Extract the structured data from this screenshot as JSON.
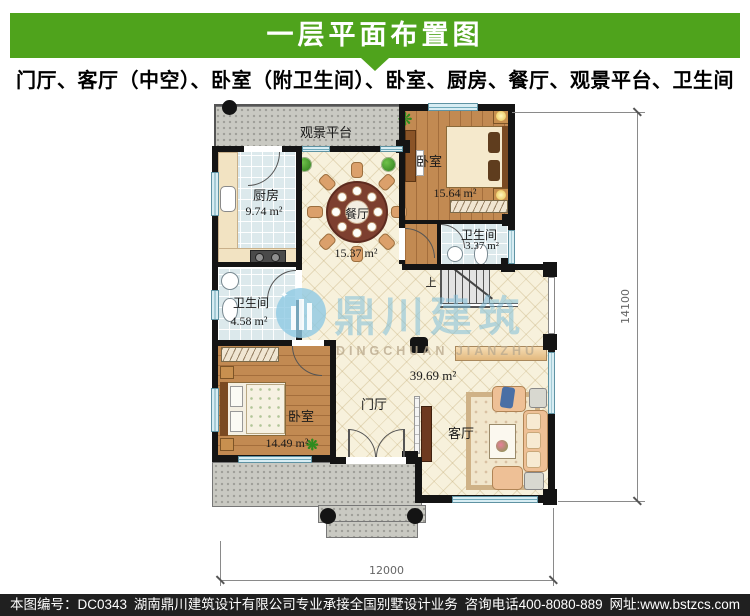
{
  "header": {
    "title": "一层平面布置图"
  },
  "subtitle": "门厅、客厅（中空）、卧室（附卫生间）、卧室、厨房、餐厅、观景平台、卫生间",
  "rooms": {
    "platform": {
      "name": "观景平台"
    },
    "kitchen": {
      "name": "厨房",
      "area": "9.74 m²"
    },
    "dining": {
      "name": "餐厅",
      "area": "15.37 m²"
    },
    "bedroom_tr": {
      "name": "卧室",
      "area": "15.64 m²"
    },
    "bath_tr": {
      "name": "卫生间",
      "area": "3.37 m²"
    },
    "bath_left": {
      "name": "卫生间",
      "area": "4.58 m²"
    },
    "bedroom_bl": {
      "name": "卧室",
      "area": "14.49 m²"
    },
    "foyer": {
      "name": "门厅"
    },
    "living": {
      "name": "客厅"
    },
    "hall_area": "39.69 m²",
    "stairs_up": "上"
  },
  "dimensions": {
    "width": "12000",
    "height": "14100"
  },
  "watermark": {
    "cn": "鼎川建筑",
    "en": "DINGCHUAN JIANZHU"
  },
  "footer": {
    "serial": "本图编号：DC0343",
    "company": "湖南鼎川建筑设计有限公司专业承接全国别墅设计业务",
    "phone": "咨询电话400-8080-889",
    "website": "网址:www.bstzcs.com"
  },
  "colors": {
    "accent_green": "#4fa31c",
    "wall": "#141414",
    "watermark_blue": "#7fbdd9"
  }
}
